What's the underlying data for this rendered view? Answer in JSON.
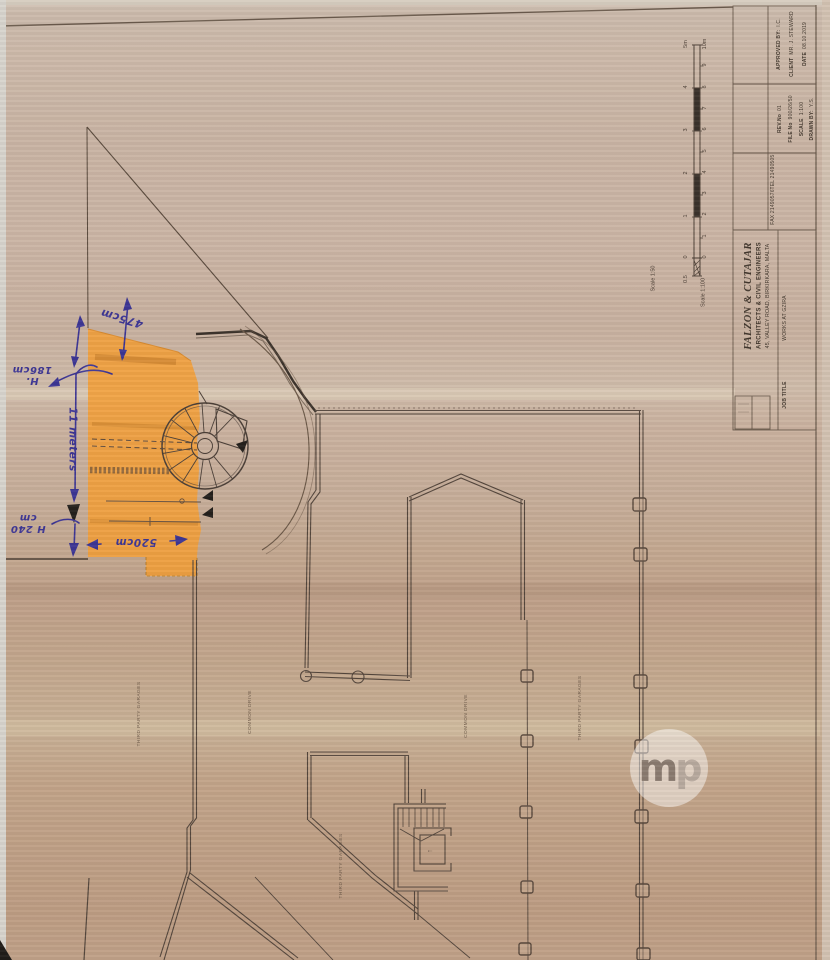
{
  "colors": {
    "paper_base": "#c8b2a0",
    "highlight_orange": "#f59f35",
    "ink_blue": "#3d3694",
    "line_brown": "#54463c"
  },
  "title_block": {
    "firm_name": "FALZON & CUTAJAR",
    "firm_subtitle": "ARCHITECTS & CIVIL ENGINEERS",
    "firm_address": "45, VALLEY ROAD, BIRKIRKARA, MALTA",
    "job_title_label": "JOB TITLE",
    "job_title_value": "WORKS AT GZIRA",
    "tel_line": "TEL  21490505",
    "fax_line": "FAX  21490576",
    "fields": [
      {
        "label": "REV.No",
        "value": "01"
      },
      {
        "label": "FILE No",
        "value": "900/26/50"
      },
      {
        "label": "SCALE",
        "value": "1:100"
      },
      {
        "label": "DRAWN BY:",
        "value": "Y.S."
      },
      {
        "label": "APPROVED BY:",
        "value": "I.C."
      },
      {
        "label": "CLIENT",
        "value": "MR. J. STEWARD"
      },
      {
        "label": "DATE",
        "value": "08.10.2019"
      }
    ]
  },
  "scale_bar": {
    "label_50": "Scale 1:50",
    "label_100": "Scale 1:100",
    "left_ticks": [
      "5m",
      "4",
      "3",
      "2",
      "1",
      "0",
      "0.5"
    ],
    "right_ticks": [
      "10m",
      "9",
      "8",
      "7",
      "6",
      "5",
      "4",
      "3",
      "2",
      "1",
      "0"
    ]
  },
  "plan_labels": [
    {
      "text": "THIRD PARTY GARAGES"
    },
    {
      "text": "COMMON DRIVE"
    },
    {
      "text": "COMMON DRIVE"
    },
    {
      "text": "THIRD PARTY GARAGES"
    },
    {
      "text": "THIRD PARTY GARAGES"
    }
  ],
  "annotations": {
    "dim_475": "475cm",
    "dim_186": "H.\n186cm",
    "dim_11m": "11 meters",
    "dim_240": "H 240\ncm",
    "dim_520": "520cm"
  },
  "stair": {
    "up_mark": "↑"
  },
  "watermark": {
    "m": "m",
    "p": "p"
  }
}
